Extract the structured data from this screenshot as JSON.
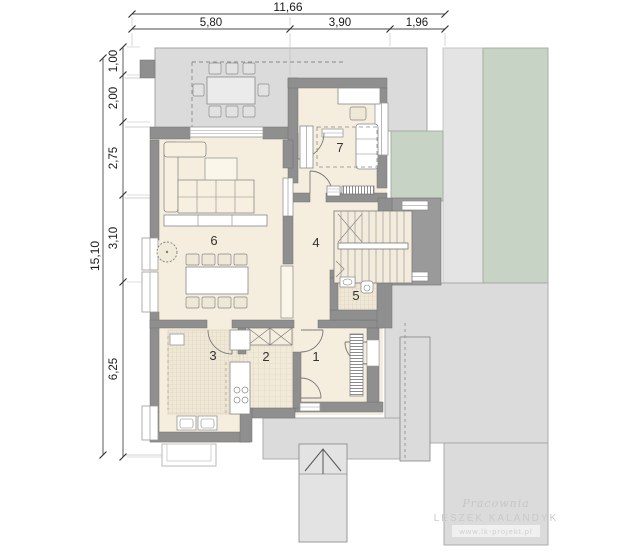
{
  "plan": {
    "dimensions_top": {
      "total": "11,66",
      "segments": [
        "5,80",
        "3,90",
        "1,96"
      ]
    },
    "dimensions_left": {
      "total": "15,10",
      "segments": [
        "1,00",
        "2,00",
        "2,75",
        "3,10",
        "6,25"
      ]
    },
    "rooms": [
      {
        "number": "1"
      },
      {
        "number": "2"
      },
      {
        "number": "3"
      },
      {
        "number": "4"
      },
      {
        "number": "5"
      },
      {
        "number": "6"
      },
      {
        "number": "7"
      }
    ],
    "watermark": {
      "studio_script": "Pracownia",
      "studio_name": "LESZEK KALANDYK",
      "website": "www.lk-projekt.pl"
    },
    "colors": {
      "floor": "#f5edde",
      "wall": "#8f8f8f",
      "paving": "#dbdbdb",
      "lawn": "#c7d3c5",
      "tile": "#efe8d6"
    }
  }
}
